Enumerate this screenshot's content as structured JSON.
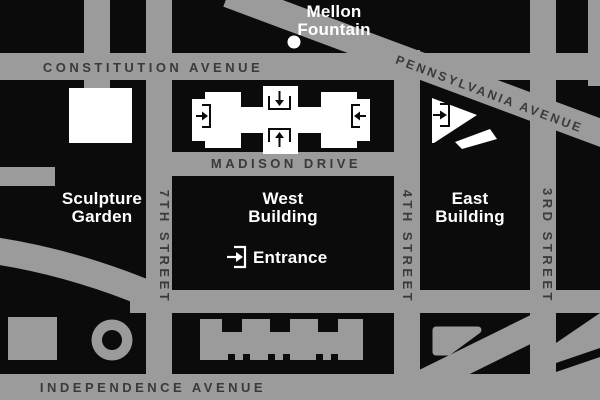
{
  "map": {
    "colors": {
      "street_gray": "#9b9b9b",
      "block_black": "#0b0b0b",
      "street_label_dark": "#3a3a3a",
      "building_label_white": "#ffffff"
    },
    "streets": {
      "constitution": "CONSTITUTION AVENUE",
      "pennsylvania": "PENNSYLVANIA AVENUE",
      "madison": "MADISON DRIVE",
      "independence": "INDEPENDENCE AVENUE",
      "seventh": "7TH STREET",
      "fourth": "4TH STREET",
      "third": "3RD STREET"
    },
    "labels": {
      "mellon_fountain": {
        "line1": "Mellon",
        "line2": "Fountain"
      },
      "sculpture_garden": {
        "line1": "Sculpture",
        "line2": "Garden"
      },
      "west_building": {
        "line1": "West",
        "line2": "Building"
      },
      "east_building": {
        "line1": "East",
        "line2": "Building"
      },
      "entrance": "Entrance"
    },
    "icons": {
      "west_building_west_entrance": "arrow-right-into-bracket",
      "west_building_north_entrance": "arrow-down-into-bracket",
      "west_building_south_entrance": "arrow-up-into-bracket",
      "west_building_east_entrance": "arrow-left-into-bracket",
      "east_building_entrance": "arrow-right-into-bracket",
      "main_entrance": "arrow-right-into-bracket",
      "mellon_fountain_marker": "white-dot"
    }
  }
}
